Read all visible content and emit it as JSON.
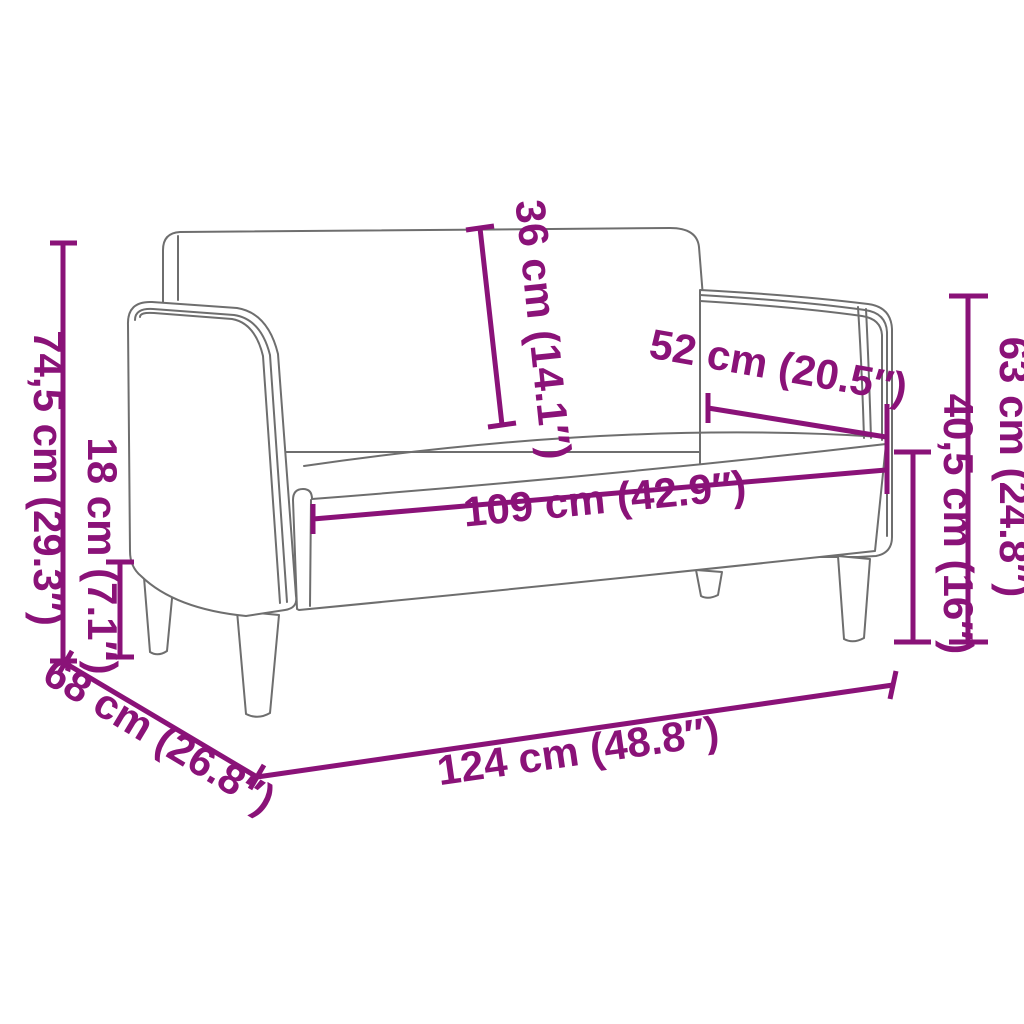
{
  "diagram": {
    "subject": "loveseat-sofa-dimension-diagram",
    "colors": {
      "dimension_accent": "#8A1278",
      "artwork_line": "#6e6e6e",
      "background": "#ffffff"
    },
    "dimensions": {
      "total_height": {
        "label": "74,5 cm (29.3″)",
        "value_cm": 74.5,
        "value_in": 29.3
      },
      "leg_height": {
        "label": "18 cm (7.1″)",
        "value_cm": 18,
        "value_in": 7.1
      },
      "backrest_height": {
        "label": "36 cm (14.1″)",
        "value_cm": 36,
        "value_in": 14.1
      },
      "seat_depth": {
        "label": "52 cm (20.5″)",
        "value_cm": 52,
        "value_in": 20.5
      },
      "seat_width": {
        "label": "109 cm (42.9″)",
        "value_cm": 109,
        "value_in": 42.9
      },
      "armrest_height": {
        "label": "63 cm (24.8″)",
        "value_cm": 63,
        "value_in": 24.8
      },
      "seat_height": {
        "label": "40,5 cm (16″)",
        "value_cm": 40.5,
        "value_in": 16
      },
      "total_depth": {
        "label": "68 cm (26.8″)",
        "value_cm": 68,
        "value_in": 26.8
      },
      "total_width": {
        "label": "124 cm (48.8″)",
        "value_cm": 124,
        "value_in": 48.8
      }
    }
  }
}
